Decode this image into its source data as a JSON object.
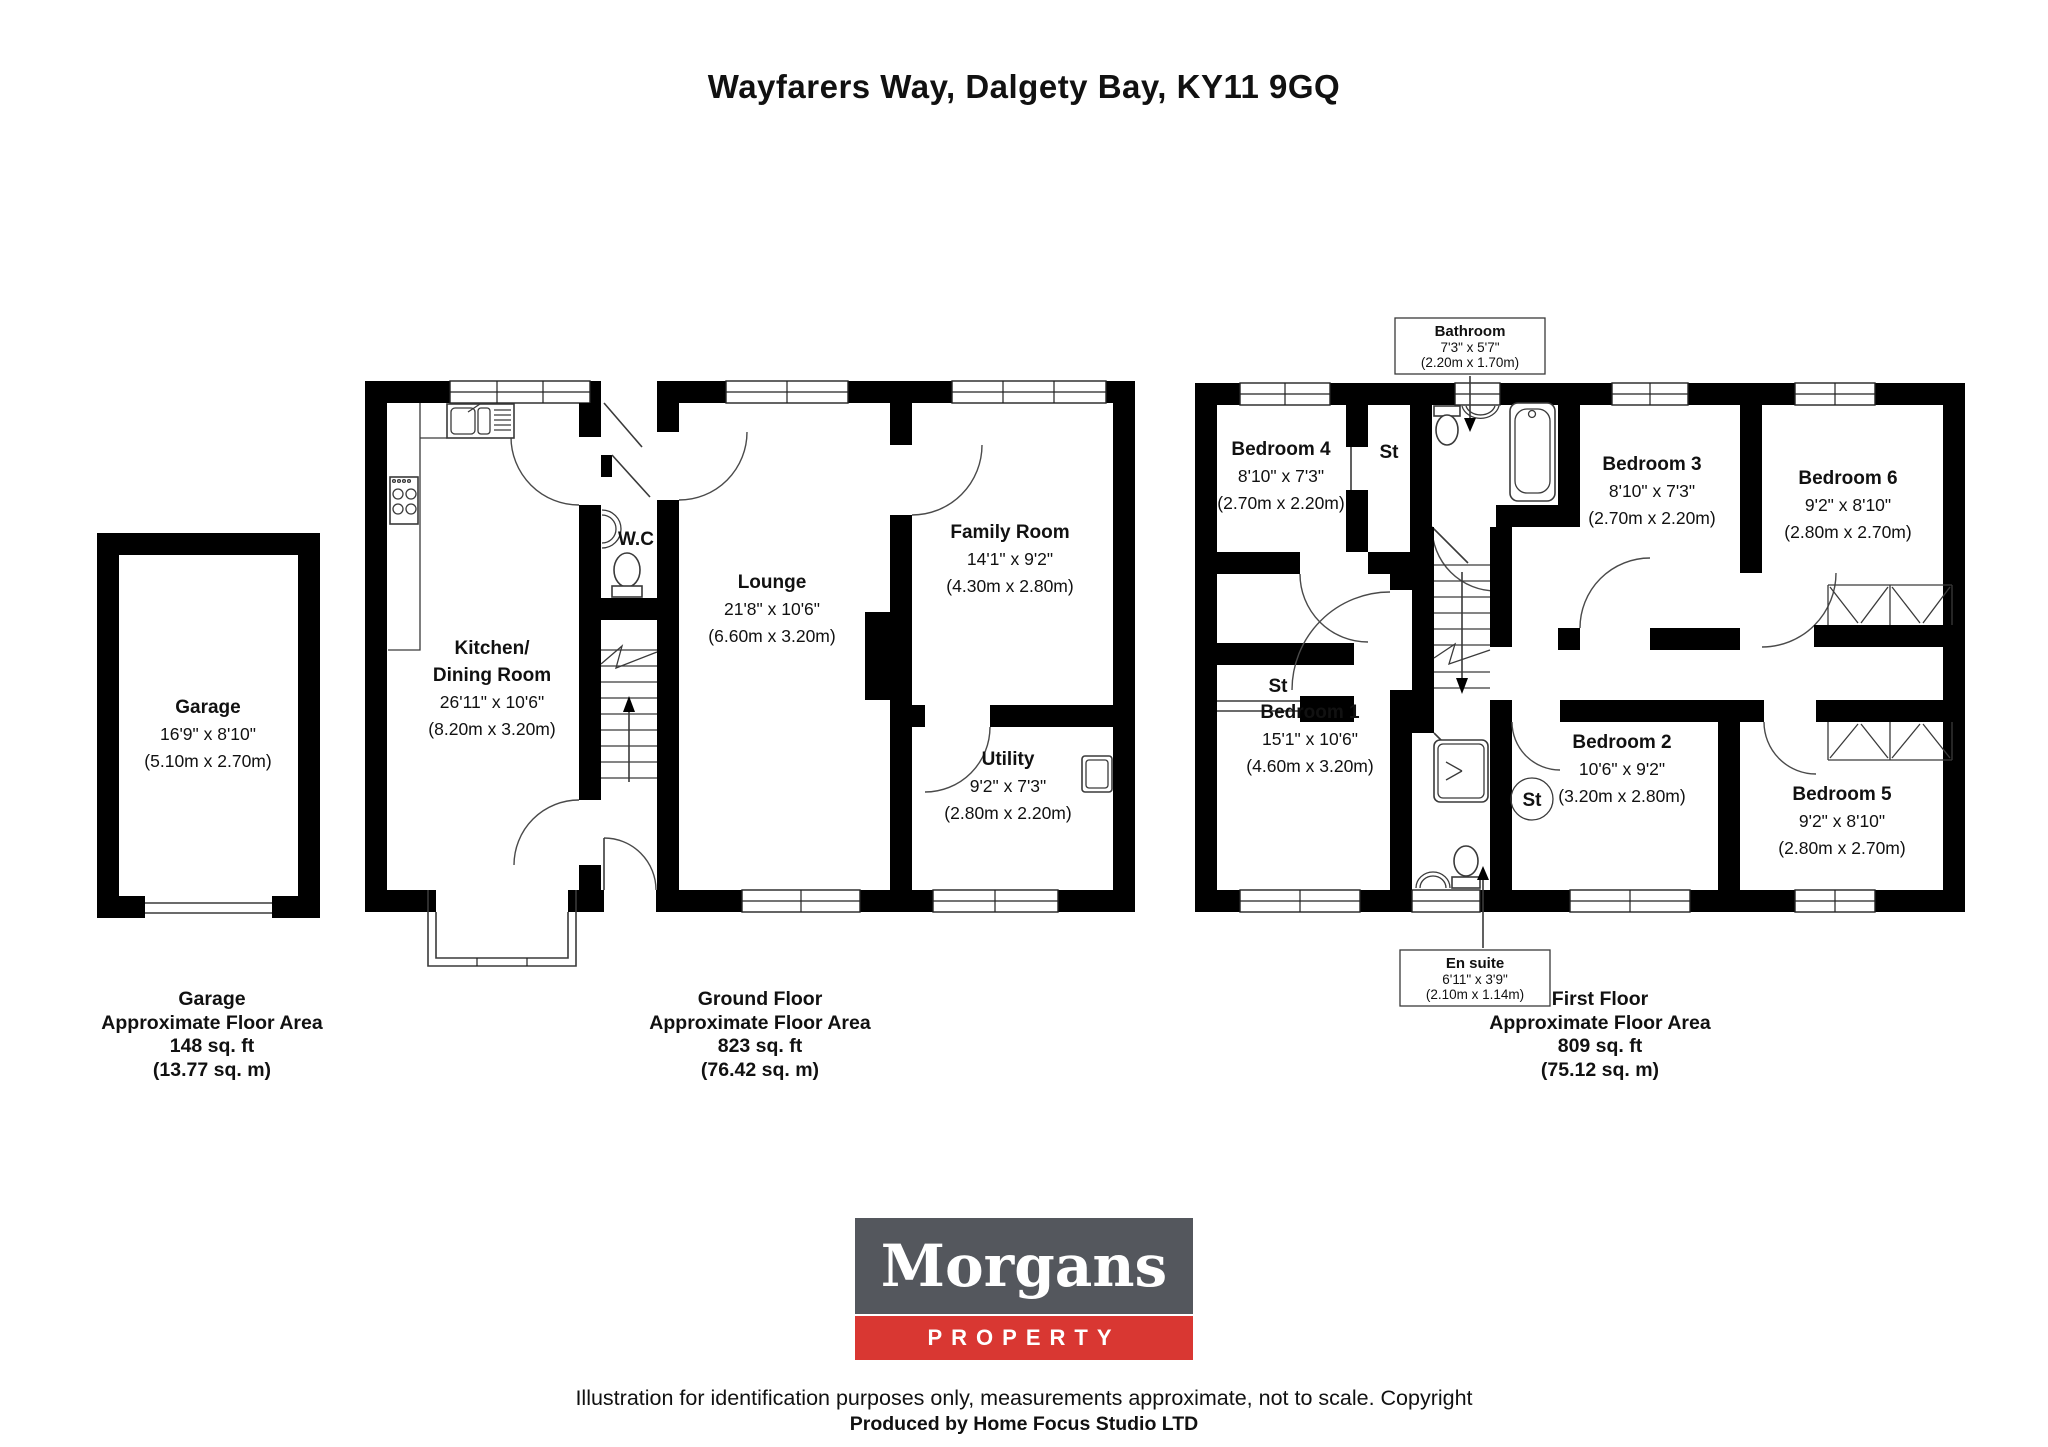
{
  "page": {
    "title": "Wayfarers Way, Dalgety Bay, KY11 9GQ",
    "disclaimer_line1": "Illustration for identification purposes only, measurements approximate, not to scale. Copyright",
    "disclaimer_line2": "Produced by Home Focus Studio LTD"
  },
  "logo": {
    "name": "Morgans",
    "tagline": "PROPERTY",
    "colors": {
      "grey": "#54575d",
      "red": "#d93732",
      "text": "#ffffff"
    }
  },
  "rooms": {
    "garage": {
      "name": "Garage",
      "imp": "16'9\" x 8'10\"",
      "met": "(5.10m x 2.70m)"
    },
    "kitchen": {
      "name1": "Kitchen/",
      "name2": "Dining Room",
      "imp": "26'11\" x 10'6\"",
      "met": "(8.20m x 3.20m)"
    },
    "lounge": {
      "name": "Lounge",
      "imp": "21'8\" x 10'6\"",
      "met": "(6.60m x 3.20m)"
    },
    "family": {
      "name": "Family Room",
      "imp": "14'1\" x 9'2\"",
      "met": "(4.30m x 2.80m)"
    },
    "utility": {
      "name": "Utility",
      "imp": "9'2\" x 7'3\"",
      "met": "(2.80m x 2.20m)"
    },
    "wc": {
      "name": "W.C"
    },
    "bed1": {
      "name": "Bedroom 1",
      "imp": "15'1\" x 10'6\"",
      "met": "(4.60m x 3.20m)"
    },
    "bed2": {
      "name": "Bedroom 2",
      "imp": "10'6\" x 9'2\"",
      "met": "(3.20m x 2.80m)"
    },
    "bed3": {
      "name": "Bedroom 3",
      "imp": "8'10\" x 7'3\"",
      "met": "(2.70m x 2.20m)"
    },
    "bed4": {
      "name": "Bedroom 4",
      "imp": "8'10\" x 7'3\"",
      "met": "(2.70m x 2.20m)"
    },
    "bed5": {
      "name": "Bedroom 5",
      "imp": "9'2\" x 8'10\"",
      "met": "(2.80m x 2.70m)"
    },
    "bed6": {
      "name": "Bedroom 6",
      "imp": "9'2\" x 8'10\"",
      "met": "(2.80m x 2.70m)"
    },
    "bathroom": {
      "name": "Bathroom",
      "imp": "7'3\" x 5'7\"",
      "met": "(2.20m x 1.70m)"
    },
    "ensuite": {
      "name": "En suite",
      "imp": "6'11\" x 3'9\"",
      "met": "(2.10m x 1.14m)"
    },
    "st": "St"
  },
  "areas": {
    "garage": {
      "title": "Garage",
      "sub": "Approximate Floor Area",
      "sqft": "148 sq. ft",
      "sqm": "(13.77 sq. m)"
    },
    "ground": {
      "title": "Ground Floor",
      "sub": "Approximate Floor Area",
      "sqft": "823 sq. ft",
      "sqm": "(76.42 sq. m)"
    },
    "first": {
      "title": "First Floor",
      "sub": "Approximate Floor Area",
      "sqft": "809 sq. ft",
      "sqm": "(75.12 sq. m)"
    }
  }
}
